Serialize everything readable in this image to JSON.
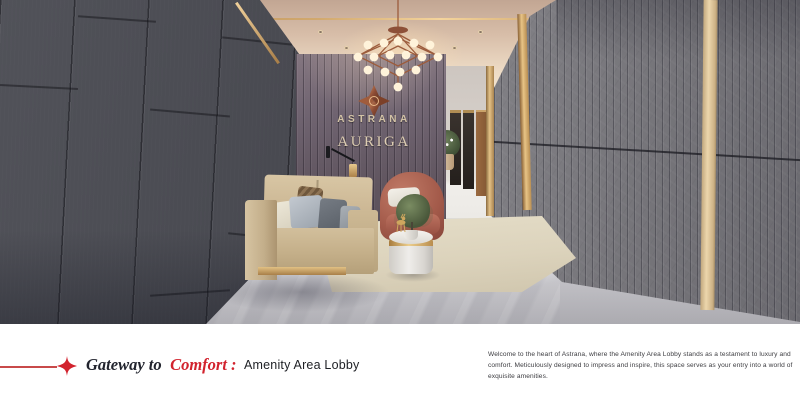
{
  "brand": {
    "name": "ASTRANA",
    "collection": "AURIGA"
  },
  "caption": {
    "heading_italic": "Gateway to",
    "heading_accent": "Comfort :",
    "heading_plain": "Amenity Area Lobby",
    "description": "Welcome to the heart of Astrana, where the Amenity Area Lobby stands as a testament to luxury and comfort. Meticulously designed to impress and inspire, this space serves as your entry into a world of exquisite amenities."
  },
  "colors": {
    "accent_red": "#d2232e",
    "gold": "#c8a05e",
    "champagne_text": "#d8c9ae"
  }
}
